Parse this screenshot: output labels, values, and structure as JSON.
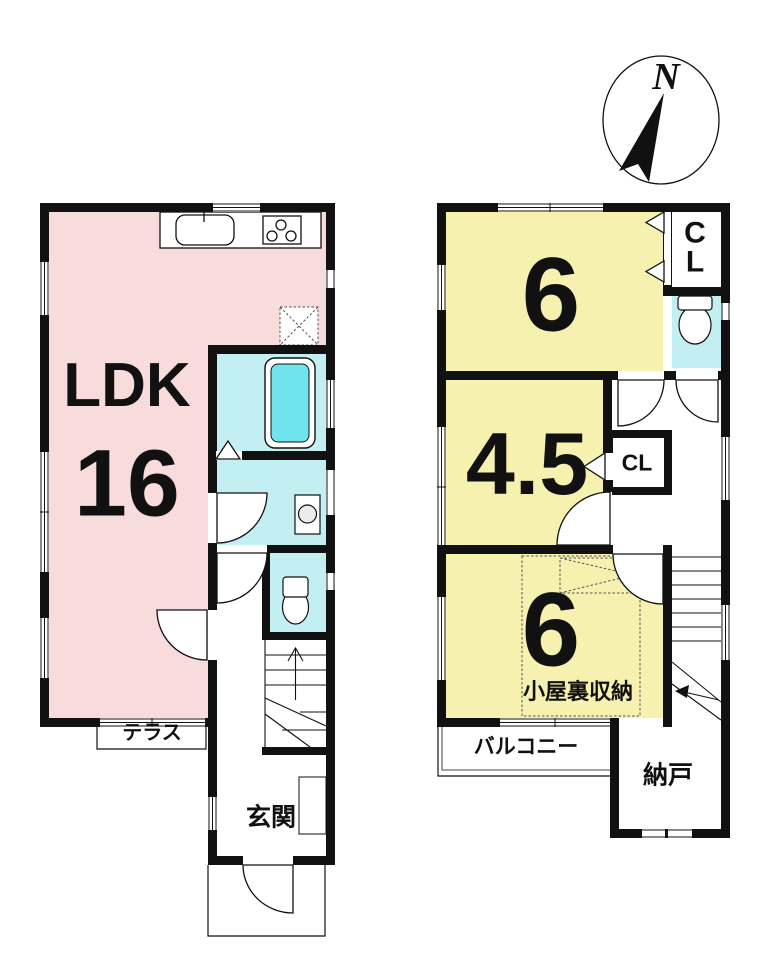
{
  "colors": {
    "wall": "#111111",
    "room-pink": "#F8DBDB",
    "room-yellow": "#F6F1AE",
    "wet-cyan": "#C4EFF2",
    "tub-cyan": "#6FE4EC"
  },
  "compass": {
    "north_label": "N"
  },
  "floor1": {
    "ldk": {
      "label": "LDK",
      "size": "16"
    },
    "terrace_label": "テラス",
    "entrance_label": "玄関"
  },
  "floor2": {
    "room_top": {
      "size": "6"
    },
    "closet_top_label": "CL",
    "room_mid": {
      "size": "4.5"
    },
    "closet_mid_label": "CL",
    "room_bottom": {
      "size": "6",
      "note": "小屋裏収納"
    },
    "balcony_label": "バルコニー",
    "storage_label": "納戸"
  }
}
